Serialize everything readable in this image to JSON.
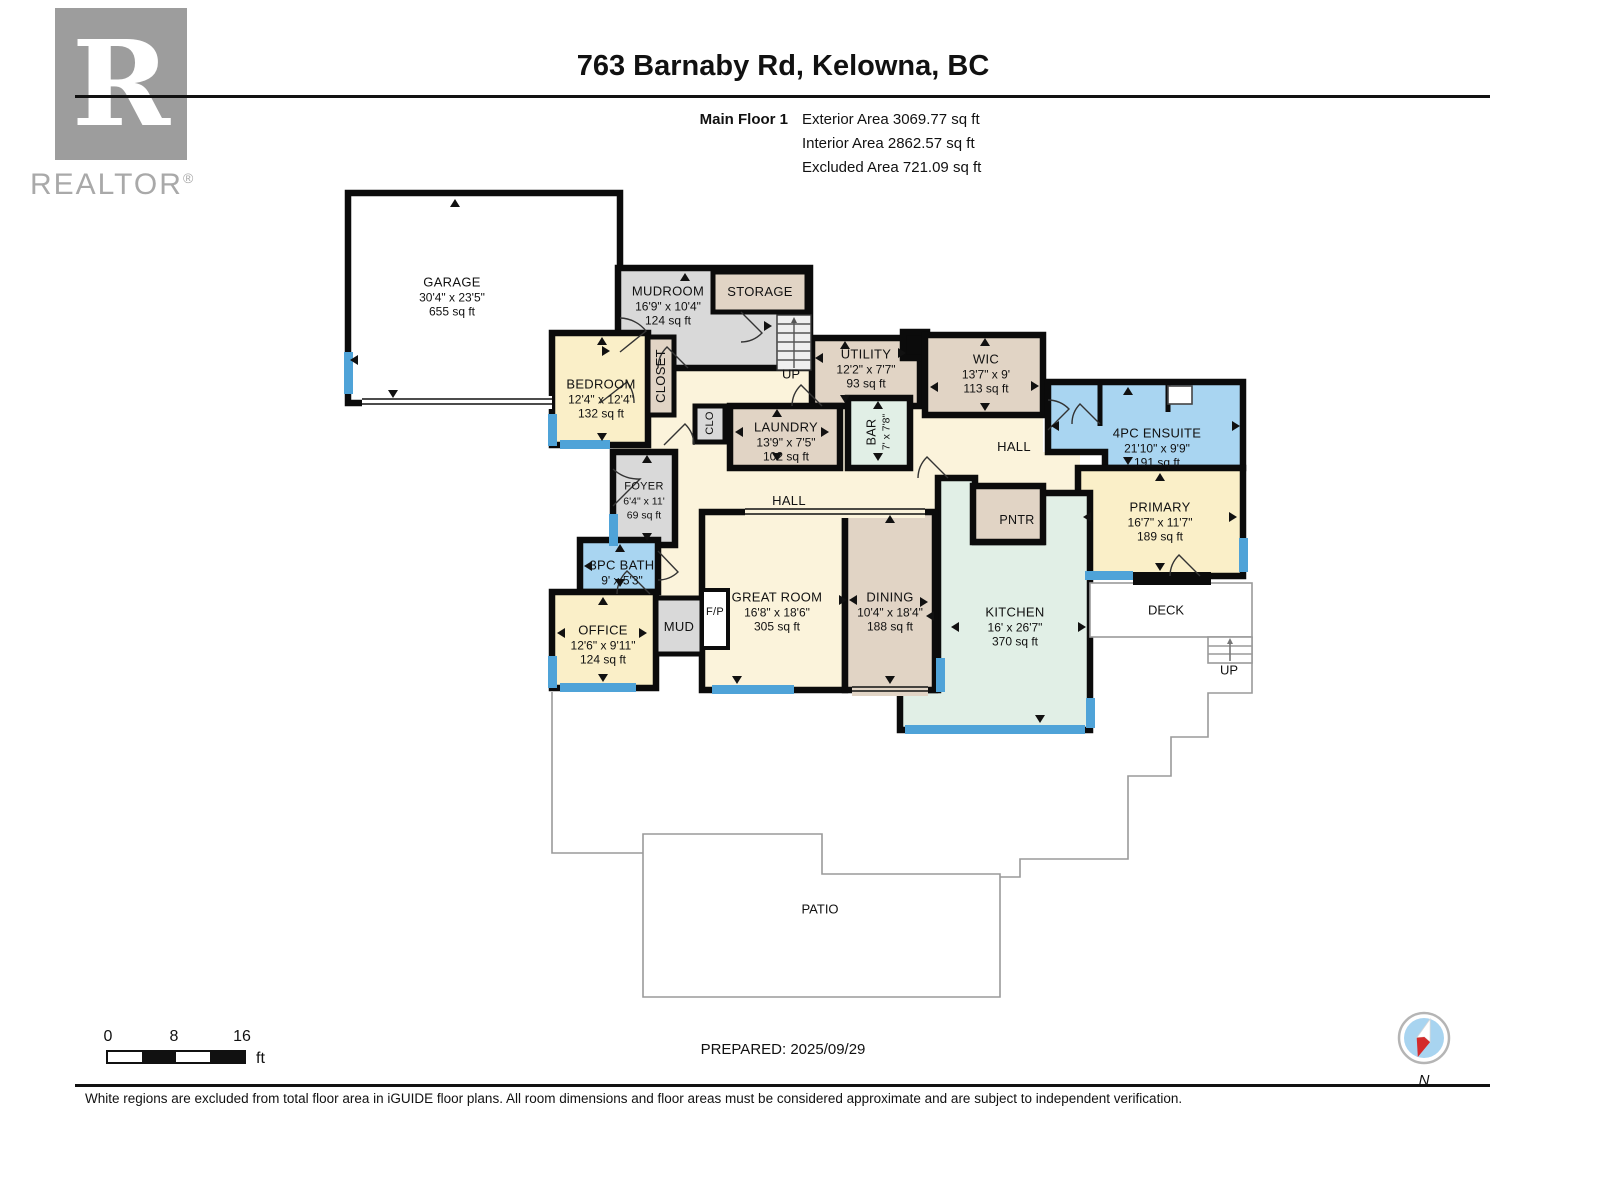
{
  "branding": {
    "logo_letter": "R",
    "logo_text": "REALTOR",
    "registered": "®"
  },
  "header": {
    "title": "763 Barnaby Rd, Kelowna, BC",
    "floor_label": "Main Floor 1",
    "stats": [
      "Exterior Area 3069.77 sq ft",
      "Interior Area 2862.57 sq ft",
      "Excluded Area 721.09 sq ft"
    ]
  },
  "rooms": {
    "garage": {
      "name": "GARAGE",
      "dims": "30'4\" x 23'5\"",
      "area": "655 sq ft"
    },
    "mudroom": {
      "name": "MUDROOM",
      "dims": "16'9\" x 10'4\"",
      "area": "124 sq ft"
    },
    "storage": {
      "name": "STORAGE"
    },
    "bedroom": {
      "name": "BEDROOM",
      "dims": "12'4\" x 12'4\"",
      "area": "132 sq ft"
    },
    "closet": {
      "name": "CLOSET"
    },
    "utility": {
      "name": "UTILITY",
      "dims": "12'2\" x 7'7\"",
      "area": "93 sq ft"
    },
    "wic": {
      "name": "WIC",
      "dims": "13'7\" x 9'",
      "area": "113 sq ft"
    },
    "laundry": {
      "name": "LAUNDRY",
      "dims": "13'9\" x 7'5\"",
      "area": "102 sq ft"
    },
    "clo": {
      "name": "CLO"
    },
    "bar": {
      "name": "BAR",
      "dims": "7' x 7'8\""
    },
    "hall": {
      "name": "HALL"
    },
    "ensuite": {
      "name": "4PC ENSUITE",
      "dims": "21'10\" x 9'9\"",
      "area": "191 sq ft"
    },
    "primary": {
      "name": "PRIMARY",
      "dims": "16'7\" x 11'7\"",
      "area": "189 sq ft"
    },
    "pntr": {
      "name": "PNTR"
    },
    "foyer": {
      "name": "FOYER",
      "dims": "6'4\" x 11'",
      "area": "69 sq ft"
    },
    "bath3pc": {
      "name": "3PC BATH",
      "dims": "9' x 5'3\""
    },
    "office": {
      "name": "OFFICE",
      "dims": "12'6\" x 9'11\"",
      "area": "124 sq ft"
    },
    "mud": {
      "name": "MUD"
    },
    "fp": {
      "name": "F/P"
    },
    "great_room": {
      "name": "GREAT ROOM",
      "dims": "16'8\" x 18'6\"",
      "area": "305 sq ft"
    },
    "dining": {
      "name": "DINING",
      "dims": "10'4\" x 18'4\"",
      "area": "188 sq ft"
    },
    "kitchen": {
      "name": "KITCHEN",
      "dims": "16' x 26'7\"",
      "area": "370 sq ft"
    },
    "deck": {
      "name": "DECK"
    },
    "patio": {
      "name": "PATIO"
    },
    "up": {
      "name": "UP"
    }
  },
  "scalebar": {
    "ticks": [
      "0",
      "8",
      "16"
    ],
    "unit": "ft"
  },
  "footer": {
    "prepared": "PREPARED: 2025/09/29",
    "compass_label": "N",
    "disclaimer": "White regions are excluded from total floor area in iGUIDE floor plans. All room dimensions and floor areas must be considered approximate and are subject to independent verification."
  },
  "colors": {
    "wall": "#0b0b0b",
    "window": "#4FA3D8",
    "room_yellow": "#FAEFC8",
    "room_tan": "#E1D4C5",
    "room_gray": "#D9D9D9",
    "room_blue": "#A9D5F1",
    "room_mint": "#E1EFE6",
    "hall_cream": "#FBF3DB",
    "excluded_line": "#9a9a9a",
    "compass_blue": "#A8D4F0",
    "compass_red": "#D42B2B"
  }
}
